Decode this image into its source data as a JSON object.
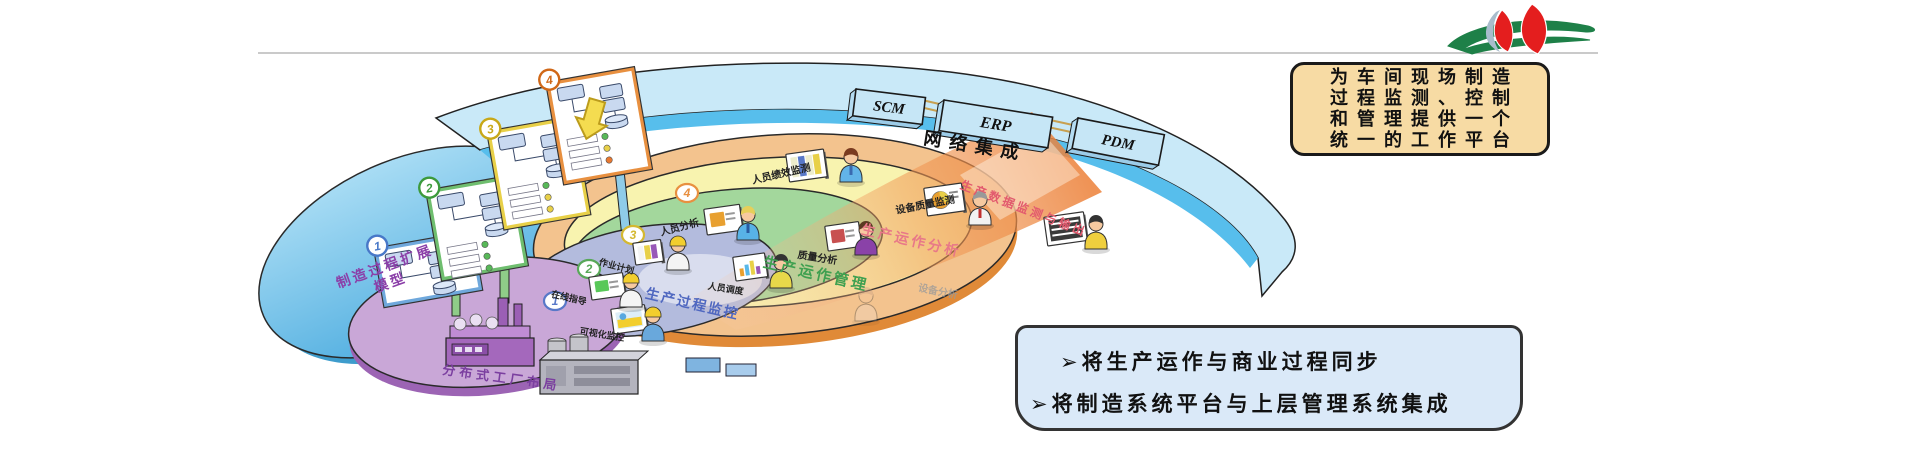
{
  "slide": {
    "bg": "#ffffff",
    "rule_color": "#b9b9b9"
  },
  "logo": {
    "name": "organization-logo",
    "petal_color": "#E41E1E",
    "leaf_color": "#1E8048"
  },
  "top_callout": {
    "bg": "#F7DBA4",
    "lines": [
      "为车间现场制造",
      "过程监测、控制",
      "和管理提供一个",
      "统一的工作平台"
    ]
  },
  "bottom_callout": {
    "bg": "#DAE9F8",
    "bullet": "➢",
    "items": [
      "将生产运作与商业过程同步",
      "将制造系统平台与上层管理系统集成"
    ]
  },
  "network_band": {
    "label": "网络集成",
    "band_color": "#57BEEC",
    "systems": [
      {
        "name": "SCM"
      },
      {
        "name": "ERP"
      },
      {
        "name": "PDM"
      }
    ]
  },
  "model_zone": {
    "title": "制造过程扩展模型",
    "title_lines": [
      "制造过程扩展",
      "模型"
    ],
    "fill": "#5FBCE8",
    "panels": [
      {
        "num": "1",
        "x": 376,
        "y": 250,
        "w": 96,
        "h": 56,
        "border": "#6FA8DC",
        "accent": "#4878C8",
        "rows": []
      },
      {
        "num": "2",
        "x": 428,
        "y": 192,
        "w": 84,
        "h": 88,
        "border": "#6FBE6F",
        "accent": "#3C9A3C",
        "rows": [
          "#58B858",
          "#58B858",
          "#58B858"
        ]
      },
      {
        "num": "3",
        "x": 489,
        "y": 133,
        "w": 84,
        "h": 96,
        "border": "#E8D048",
        "accent": "#C8A818",
        "rows": [
          "#58B858",
          "#E8D048",
          "#E8D048"
        ]
      },
      {
        "num": "4",
        "x": 548,
        "y": 84,
        "w": 86,
        "h": 100,
        "border": "#E89040",
        "accent": "#D06818",
        "rows": [
          "#58B858",
          "#E8D048",
          "#E87830"
        ]
      }
    ]
  },
  "rings": [
    {
      "name": "production-data-layer",
      "badge": "4",
      "badge_color": "#E89040",
      "fill": "#F3C38E",
      "labels": [
        "人员绩效监测",
        "设备质量监测"
      ],
      "highlight_label": "生产数据监测与输出",
      "highlight_color": "#E25A6E"
    },
    {
      "name": "operation-analysis-layer",
      "badge": "3",
      "badge_color": "#D4B830",
      "fill": "#F8F3AF",
      "title": "生产运作分析",
      "title_color": "#E87888",
      "labels": [
        "人员分析",
        "质量分析",
        "设备分析"
      ]
    },
    {
      "name": "operation-management-layer",
      "badge": "2",
      "badge_color": "#58A858",
      "fill": "#A3D79C",
      "title": "生产运作管理",
      "title_color": "#3FA050",
      "labels": [
        "作业计划",
        "人员调度"
      ]
    },
    {
      "name": "process-monitoring-layer",
      "badge": "1",
      "badge_color": "#5878C8",
      "fill": "#B3BBDD",
      "title": "生产过程监控",
      "title_color": "#5068C0",
      "labels": [
        "在线指导",
        "可视化监控"
      ]
    },
    {
      "name": "distributed-factory-layer",
      "fill": "#C9A7D7",
      "title": "分布式工厂布局",
      "title_color": "#7B3FA0"
    }
  ],
  "beam": {
    "color": "#EC8038"
  },
  "devices": [
    {
      "name": "personnel-performance-report",
      "style": "stripes",
      "x": 788,
      "y": 156,
      "w": 34,
      "h": 24,
      "colors": [
        "#EDEDCD",
        "#5878C8",
        "#EDEDCD",
        "#E8D048"
      ]
    },
    {
      "name": "equipment-quality-chart",
      "style": "pie",
      "x": 926,
      "y": 190,
      "w": 34,
      "h": 24,
      "colors": [
        "#E8A030",
        "#E8D048",
        "#5878C8"
      ]
    },
    {
      "name": "personnel-analysis-screen",
      "style": "screen",
      "x": 706,
      "y": 211,
      "w": 32,
      "h": 22,
      "colors": [
        "#E8A030"
      ]
    },
    {
      "name": "quality-analysis-screen",
      "style": "screen",
      "x": 827,
      "y": 228,
      "w": 30,
      "h": 21,
      "colors": [
        "#C85050"
      ]
    },
    {
      "name": "job-plan-board",
      "style": "stripes",
      "x": 635,
      "y": 245,
      "w": 24,
      "h": 18,
      "colors": [
        "#F4F4F4",
        "#E8D048",
        "#9858B8"
      ]
    },
    {
      "name": "dispatch-board",
      "style": "bars",
      "x": 735,
      "y": 259,
      "w": 28,
      "h": 20,
      "colors": [
        "#E8A030",
        "#58B8E8",
        "#E8D048",
        "#9858B8"
      ]
    },
    {
      "name": "online-guidance-screen",
      "style": "screen",
      "x": 591,
      "y": 279,
      "w": 30,
      "h": 19,
      "colors": [
        "#58C858"
      ]
    },
    {
      "name": "visual-monitoring-screen",
      "style": "image",
      "x": 613,
      "y": 311,
      "w": 30,
      "h": 21,
      "colors": [
        "#F2CE2E",
        "#58A8E0"
      ]
    },
    {
      "name": "data-terminal",
      "style": "rows",
      "x": 1046,
      "y": 219,
      "w": 36,
      "h": 25,
      "colors": [
        "#3A3A3A"
      ]
    }
  ],
  "actors": [
    {
      "role": "performance-monitor-staff",
      "x": 851,
      "y": 157,
      "shirt": "#62B4E8",
      "hair": "#7A3B20",
      "tie": "#3A6AB0"
    },
    {
      "role": "quality-monitor-staff",
      "x": 980,
      "y": 200,
      "shirt": "#F2F2F2",
      "hair": "#999999",
      "tie": "#C03030"
    },
    {
      "role": "data-terminal-operator",
      "x": 1096,
      "y": 224,
      "shirt": "#EFCF3E",
      "hair": "#333333"
    },
    {
      "role": "personnel-analyst",
      "x": 748,
      "y": 215,
      "shirt": "#58B2E6",
      "hair": "#E6CF5A",
      "tie": "#2A5AA0"
    },
    {
      "role": "operation-analyst",
      "x": 866,
      "y": 230,
      "shirt": "#8A42A8",
      "hair": "#5A3A22"
    },
    {
      "role": "plan-supervisor",
      "x": 678,
      "y": 245,
      "shirt": "#F4F4F4",
      "helmet": "#F2CE2E"
    },
    {
      "role": "dispatcher",
      "x": 781,
      "y": 263,
      "shirt": "#E8D84A",
      "hair": "#333333"
    },
    {
      "role": "process-supervisor",
      "x": 631,
      "y": 282,
      "shirt": "#F4F4F4",
      "helmet": "#F2CE2E"
    },
    {
      "role": "field-operator",
      "x": 653,
      "y": 316,
      "shirt": "#69A8DC",
      "helmet": "#F2CE2E"
    },
    {
      "role": "ghost-operator",
      "x": 866,
      "y": 296,
      "shirt": "#EED9C8",
      "hair": "#C8A088",
      "opacity": 0.35
    }
  ]
}
